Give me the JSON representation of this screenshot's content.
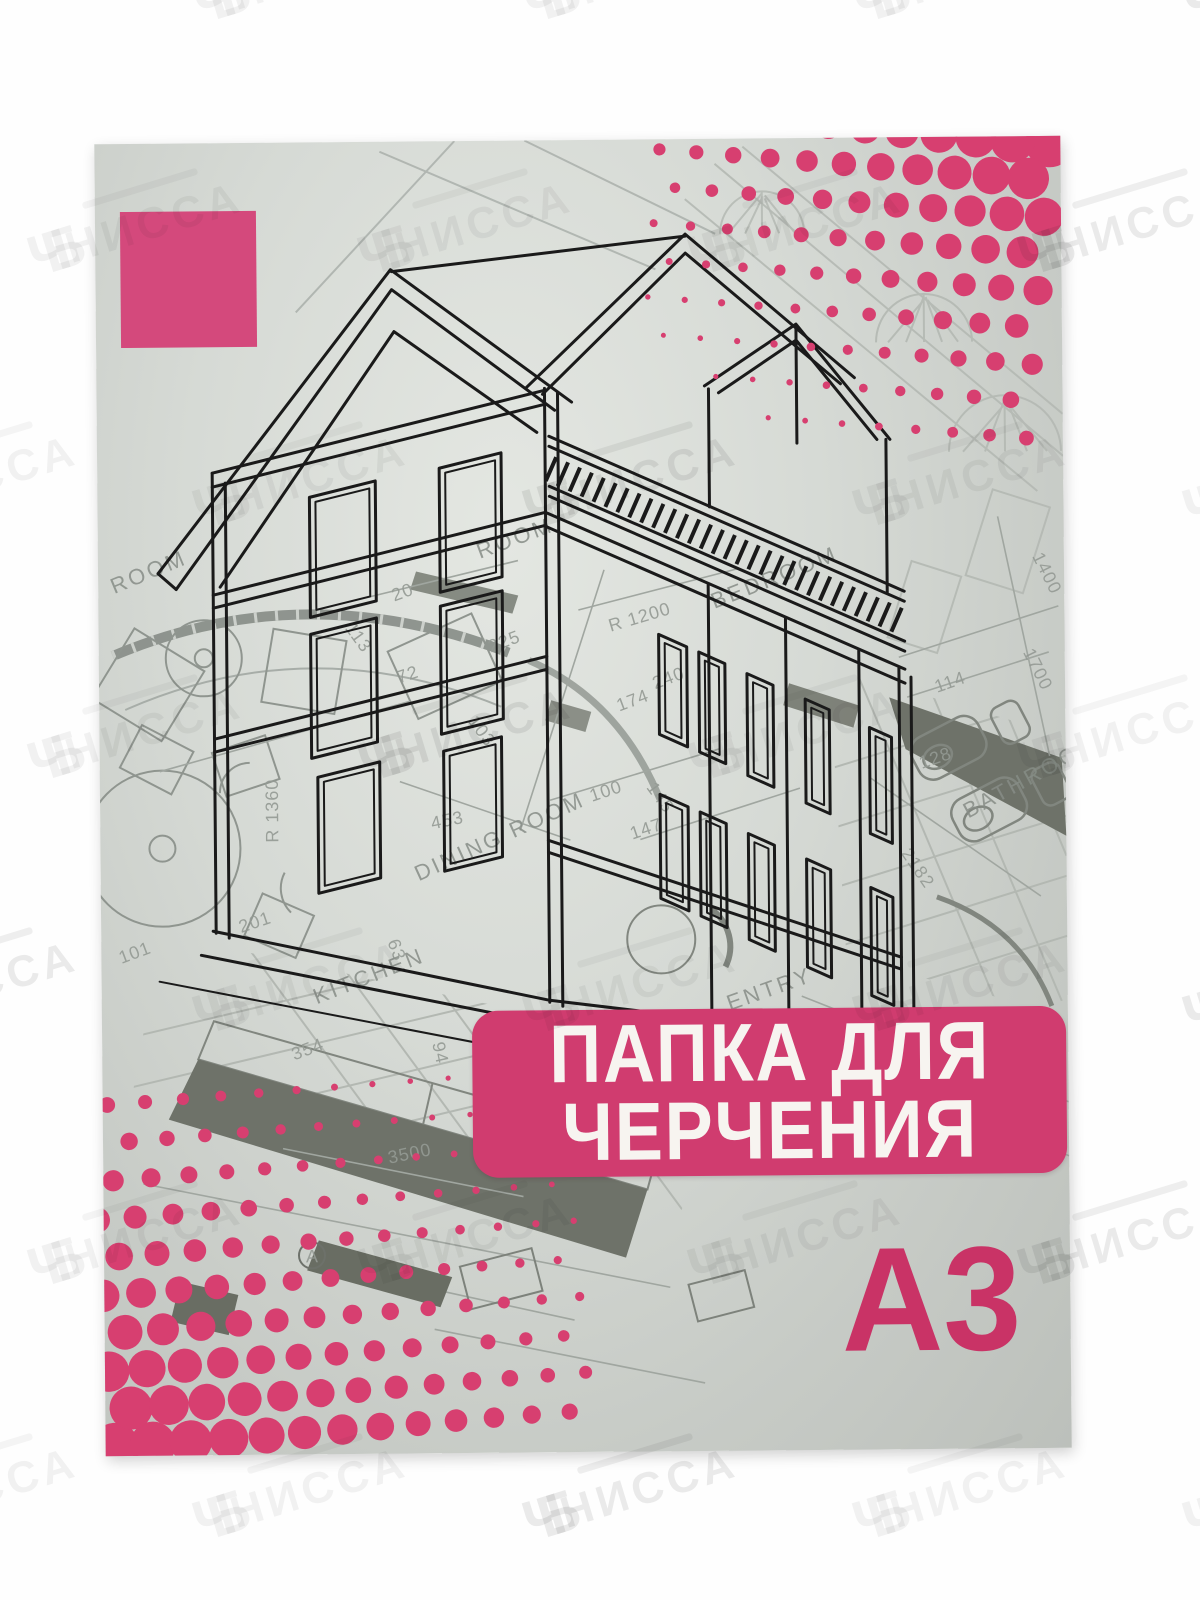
{
  "product": {
    "title_line1": "ПАПКА ДЛЯ",
    "title_line2": "ЧЕРЧЕНИЯ",
    "format": "А3"
  },
  "watermark": {
    "brand": "НИССА"
  },
  "colors": {
    "banner_magenta": "#d03c6f",
    "square_magenta": "#d4497c",
    "dots_magenta": "#d73f70",
    "format_magenta": "#c93366",
    "cover_gray": "#ccd0cb",
    "house_ink": "#1a1a1a",
    "blueprint_light": "#a7ada8",
    "blueprint_dark": "#6e7269"
  },
  "blueprint": {
    "rooms": [
      "ROOM",
      "ROOM",
      "DINING ROOM",
      "KITCHEN",
      "ENTRY",
      "BATHROOM",
      "BEDROOM"
    ],
    "dims": [
      "453",
      "R 1360",
      "R 1200",
      "225",
      "20",
      "240",
      "174",
      "114",
      "128",
      "2182",
      "1700",
      "1400",
      "3500",
      "354",
      "101",
      "145",
      "147",
      "100",
      "201",
      "72",
      "113",
      "103",
      "94",
      "63"
    ],
    "marker": "A"
  }
}
